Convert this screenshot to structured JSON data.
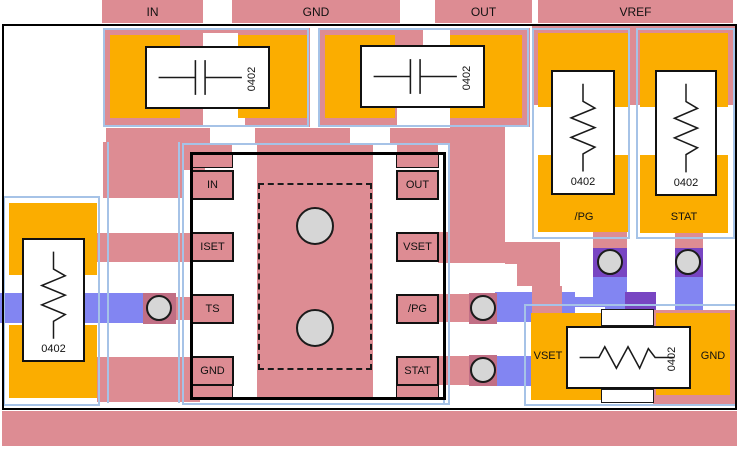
{
  "colors": {
    "copper_top": "#DD8C93",
    "copper_bottom": "#8285F2",
    "copper_bottom_dark": "#7845C2",
    "copper_overlap": "#C16F85",
    "pad": "#FBAD00",
    "courtyard_outline": "#A6C3E7",
    "via_fill": "#D6D6D6",
    "board_outline": "#000000"
  },
  "top_tabs": [
    {
      "label": "IN"
    },
    {
      "label": "GND"
    },
    {
      "label": "OUT"
    },
    {
      "label": "VREF"
    }
  ],
  "ic": {
    "left_pins": [
      "IN",
      "ISET",
      "TS",
      "GND"
    ],
    "right_pins": [
      "OUT",
      "VSET",
      "/PG",
      "STAT"
    ]
  },
  "capacitors": [
    {
      "size_label": "0402"
    },
    {
      "size_label": "0402"
    }
  ],
  "resistors": {
    "left": {
      "size_label": "0402"
    },
    "pg": {
      "size_label": "0402",
      "net_label": "/PG"
    },
    "stat": {
      "size_label": "0402",
      "net_label": "STAT"
    },
    "bottom": {
      "size_label": "0402",
      "left_label": "VSET",
      "right_label": "GND"
    }
  }
}
